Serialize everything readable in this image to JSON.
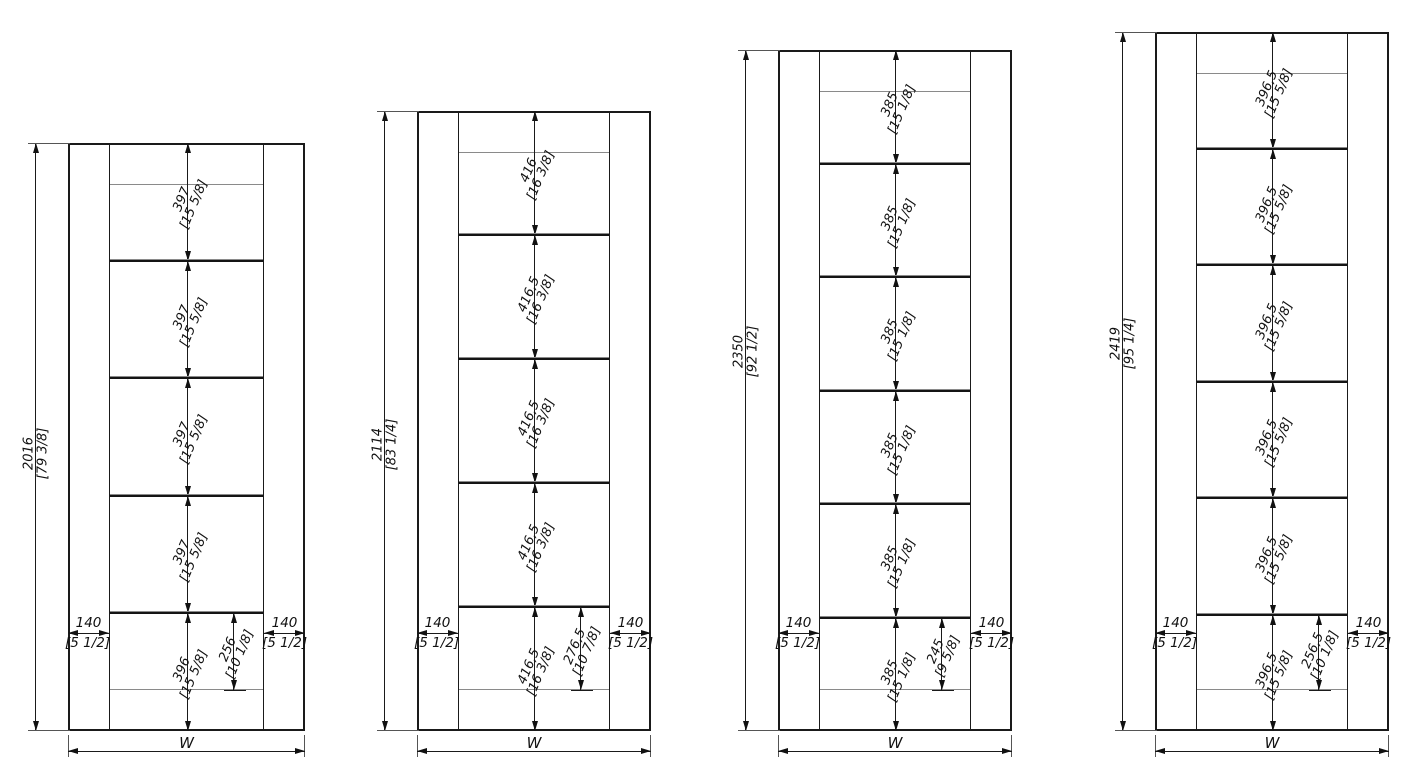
{
  "colors": {
    "line": "#1a1a1a",
    "thin_line": "#8a8a8a",
    "background": "#ffffff"
  },
  "drawing": {
    "cabinets": [
      {
        "name": "cabinet-1",
        "total": {
          "mm": "2016",
          "in": "[79 3/8]"
        },
        "spacings": [
          {
            "mm": "397",
            "in": "[15 5/8]"
          },
          {
            "mm": "397",
            "in": "[15 5/8]"
          },
          {
            "mm": "397",
            "in": "[15 5/8]"
          },
          {
            "mm": "397",
            "in": "[15 5/8]"
          }
        ],
        "bottom": {
          "mm": "396",
          "in": "[15 5/8]"
        },
        "inset": {
          "mm": "256",
          "in": "[10 1/8]"
        },
        "stile": {
          "mm": "140",
          "in": "[5 1/2]"
        },
        "width_label": "W"
      },
      {
        "name": "cabinet-2",
        "total": {
          "mm": "2114",
          "in": "[83 1/4]"
        },
        "spacings": [
          {
            "mm": "416",
            "in": "[16 3/8]"
          },
          {
            "mm": "416,5",
            "in": "[16 3/8]"
          },
          {
            "mm": "416,5",
            "in": "[16 3/8]"
          },
          {
            "mm": "416,5",
            "in": "[16 3/8]"
          }
        ],
        "bottom": {
          "mm": "416,5",
          "in": "[16 3/8]"
        },
        "inset": {
          "mm": "276,5",
          "in": "[10 7/8]"
        },
        "stile": {
          "mm": "140",
          "in": "[5 1/2]"
        },
        "width_label": "W"
      },
      {
        "name": "cabinet-3",
        "total": {
          "mm": "2350",
          "in": "[92 1/2]"
        },
        "spacings": [
          {
            "mm": "385",
            "in": "[15 1/8]"
          },
          {
            "mm": "385",
            "in": "[15 1/8]"
          },
          {
            "mm": "385",
            "in": "[15 1/8]"
          },
          {
            "mm": "385",
            "in": "[15 1/8]"
          },
          {
            "mm": "385",
            "in": "[15 1/8]"
          }
        ],
        "bottom": {
          "mm": "385",
          "in": "[15 1/8]"
        },
        "inset": {
          "mm": "245",
          "in": "[9 5/8]"
        },
        "stile": {
          "mm": "140",
          "in": "[5 1/2]"
        },
        "width_label": "W"
      },
      {
        "name": "cabinet-4",
        "total": {
          "mm": "2419",
          "in": "[95 1/4]"
        },
        "spacings": [
          {
            "mm": "396,5",
            "in": "[15 5/8]"
          },
          {
            "mm": "396,5",
            "in": "[15 5/8]"
          },
          {
            "mm": "396,5",
            "in": "[15 5/8]"
          },
          {
            "mm": "396,5",
            "in": "[15 5/8]"
          },
          {
            "mm": "396,5",
            "in": "[15 5/8]"
          }
        ],
        "bottom": {
          "mm": "396,5",
          "in": "[15 5/8]"
        },
        "inset": {
          "mm": "256,5",
          "in": "[10 1/8]"
        },
        "stile": {
          "mm": "140",
          "in": "[5 1/2]"
        },
        "width_label": "W"
      }
    ]
  }
}
